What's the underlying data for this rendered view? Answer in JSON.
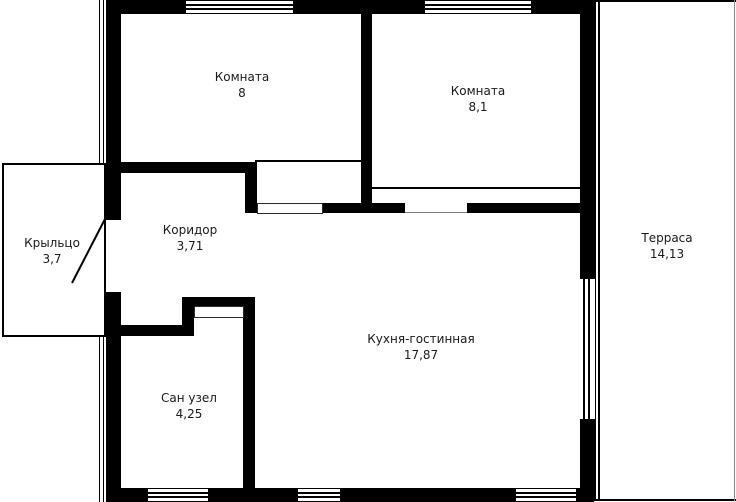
{
  "plan": {
    "rooms": [
      {
        "id": "room-1",
        "name": "Комната",
        "area": "8"
      },
      {
        "id": "room-2",
        "name": "Комната",
        "area": "8,1"
      },
      {
        "id": "terrace",
        "name": "Терраса",
        "area": "14,13"
      },
      {
        "id": "porch",
        "name": "Крыльцо",
        "area": "3,7"
      },
      {
        "id": "corridor",
        "name": "Коридор",
        "area": "3,71"
      },
      {
        "id": "kitchen",
        "name": "Кухня-гостинная",
        "area": "17,87"
      },
      {
        "id": "bathroom",
        "name": "Сан узел",
        "area": "4,25"
      }
    ],
    "colors": {
      "wall": "#000000",
      "background": "#ffffff",
      "text": "#1a1a1a"
    }
  }
}
